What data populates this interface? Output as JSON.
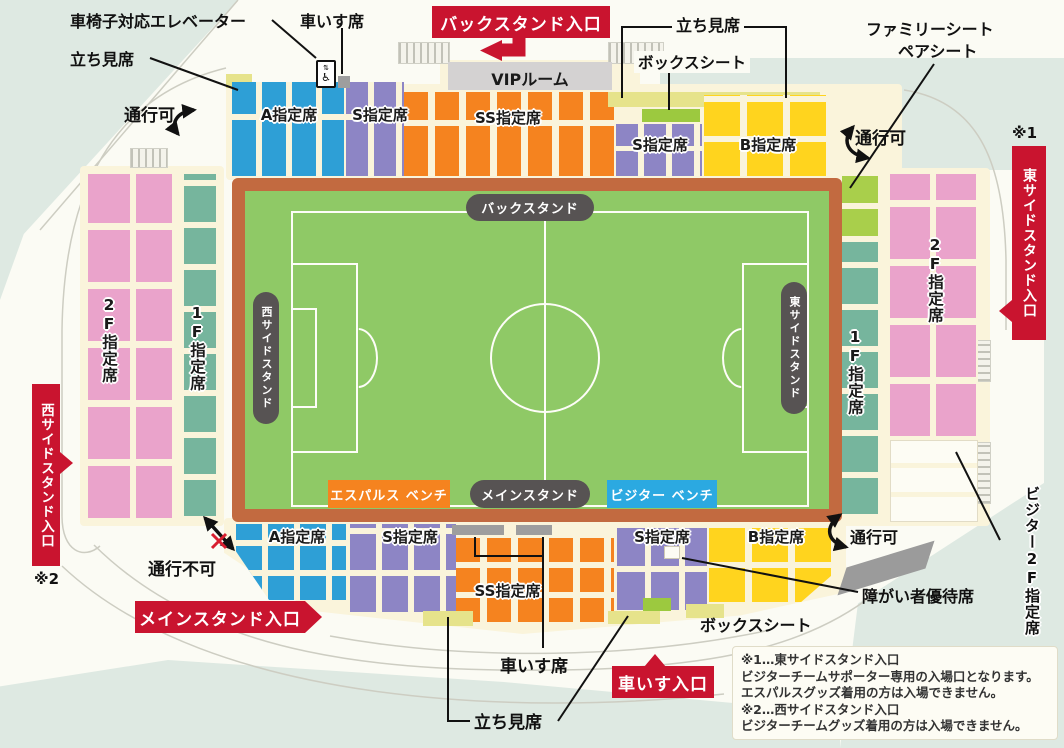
{
  "title": "スタジアム座席図",
  "colors": {
    "seat_a": "#2E9FD6",
    "seat_s": "#8D85C5",
    "seat_ss": "#F5831F",
    "seat_b": "#FFD41E",
    "standing": "#E6E38B",
    "box_seat": "#9CC93F",
    "family_seat": "#A9CF4B",
    "seat_2f": "#EAA3CB",
    "seat_1f": "#76B59D",
    "field_green": "#8FC966",
    "track": "#C26A40",
    "banner_red": "#C9142F",
    "pill_dark": "#575353",
    "home_bench": "#F5831F",
    "visitor_bench": "#2BA9E1",
    "vip_gray": "#D4D2D2",
    "gray_block": "#9E9E9E"
  },
  "annotations": {
    "wheelchair_elevator": "車椅子対応エレベーター",
    "wheelchair_seat_top": "車いす席",
    "standing_top_left": "立ち見席",
    "standing_top_right": "立ち見席",
    "box_seat_top": "ボックスシート",
    "family_seat_line1": "ファミリーシート",
    "family_seat_line2": "ペアシート",
    "passable_top_left": "通行可",
    "passable_top_right": "通行可",
    "passable_bottom_right": "通行可",
    "no_passage": "通行不可",
    "wheelchair_seat_bottom": "車いす席",
    "standing_bottom": "立ち見席",
    "box_seat_bottom": "ボックスシート",
    "disabled_priority_seat": "障がい者優待席",
    "visitor_2f": "ビジター2F指定席",
    "ref1": "※1",
    "ref2": "※2"
  },
  "entrances": {
    "back": "バックスタンド入口",
    "east": "東サイドスタンド入口",
    "west": "西サイドスタンド入口",
    "main": "メインスタンド入口",
    "wheelchair": "車いす入口"
  },
  "stands": {
    "back": {
      "a": "A指定席",
      "s": "S指定席",
      "ss": "SS指定席",
      "vip": "VIPルーム",
      "s2": "S指定席",
      "b": "B指定席"
    },
    "west": {
      "f2": "2F指定席",
      "f1": "1F指定席"
    },
    "east": {
      "f1": "1F指定席",
      "f2": "2F指定席"
    },
    "main": {
      "a": "A指定席",
      "s": "S指定席",
      "ss": "SS指定席",
      "s2": "S指定席",
      "b": "B指定席"
    }
  },
  "field": {
    "back_stand": "バックスタンド",
    "west_stand": "西サイドスタンド",
    "east_stand": "東サイドスタンド",
    "main_stand": "メインスタンド",
    "home_bench": "エスパルス ベンチ",
    "visitor_bench": "ビジター ベンチ"
  },
  "notes": {
    "lines": [
      "※1…東サイドスタンド入口",
      "ビジターチームサポーター専用の入場口となります。",
      "エスパルスグッズ着用の方は入場できません。",
      "※2…西サイドスタンド入口",
      "ビジターチームグッズ着用の方は入場できません。"
    ]
  },
  "icons": {
    "wheelchair": "♿",
    "arrows_updown": "⇅"
  }
}
